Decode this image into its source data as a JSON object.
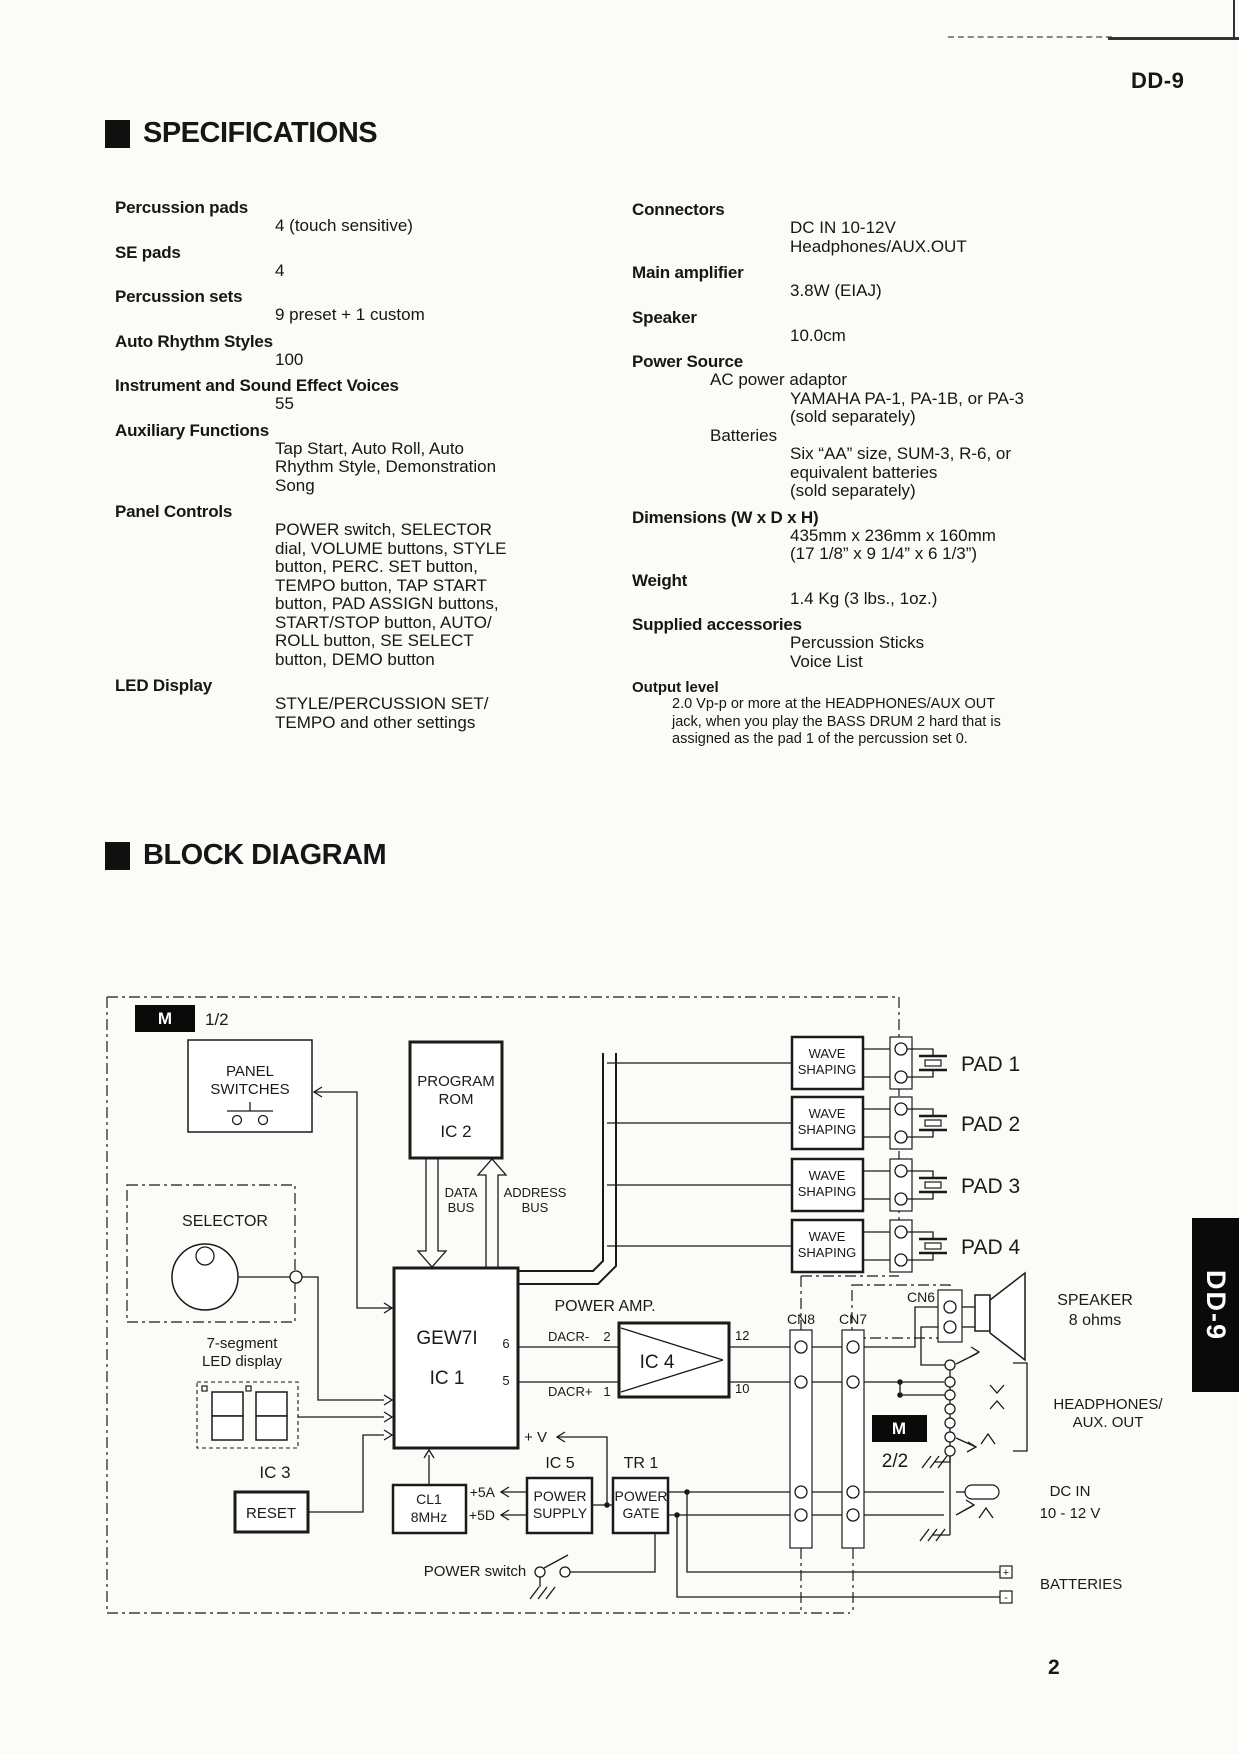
{
  "page": {
    "model": "DD-9",
    "number": "2",
    "side_tab": "DD-9"
  },
  "colors": {
    "ink": "#1a1a1a",
    "paper": "#fbfbf8"
  },
  "specifications": {
    "title": "SPECIFICATIONS",
    "left": [
      {
        "label": "Percussion pads",
        "value": "4 (touch sensitive)"
      },
      {
        "label": "SE pads",
        "value": "4"
      },
      {
        "label": "Percussion sets",
        "value": "9 preset + 1 custom"
      },
      {
        "label": "Auto Rhythm Styles",
        "value": "100"
      },
      {
        "label": "Instrument  and Sound Effect Voices",
        "value": "55"
      },
      {
        "label": "Auxiliary Functions",
        "value": "Tap Start, Auto Roll, Auto\nRhythm Style, Demonstration\nSong"
      },
      {
        "label": "Panel Controls",
        "value": "POWER switch, SELECTOR\ndial, VOLUME buttons, STYLE\nbutton, PERC. SET button,\nTEMPO button, TAP START\nbutton, PAD ASSIGN buttons,\nSTART/STOP button, AUTO/\nROLL button, SE SELECT\nbutton, DEMO button"
      },
      {
        "label": "LED Display",
        "value": "STYLE/PERCUSSION SET/\nTEMPO and other settings"
      }
    ],
    "right": [
      {
        "label": "Connectors",
        "value": "DC IN 10-12V\nHeadphones/AUX.OUT"
      },
      {
        "label": "Main amplifier",
        "value": "3.8W (EIAJ)"
      },
      {
        "label": "Speaker",
        "value": "10.0cm"
      },
      {
        "label": "Power Source",
        "sub1": "AC power adaptor",
        "sub1_value": "YAMAHA PA-1, PA-1B, or PA-3\n(sold separately)",
        "sub2": "Batteries",
        "sub2_value": "Six “AA” size, SUM-3, R-6, or\nequivalent batteries\n(sold separately)"
      },
      {
        "label": "Dimensions (W x D x H)",
        "value": "435mm x 236mm x 160mm\n(17 1/8” x 9 1/4” x 6 1/3”)"
      },
      {
        "label": "Weight",
        "value": "1.4 Kg (3 lbs., 1oz.)"
      },
      {
        "label": "Supplied accessories",
        "value": "Percussion Sticks\nVoice List"
      }
    ],
    "output_level": {
      "label": "Output level",
      "text": "2.0 Vp-p or more at the HEADPHONES/AUX OUT\njack, when you play the BASS DRUM 2 hard that is\nassigned as the pad 1 of the percussion set 0."
    }
  },
  "block_diagram": {
    "title": "BLOCK DIAGRAM",
    "marker_m": "M",
    "marker1_page": "1/2",
    "marker2_page": "2/2",
    "panel_switches_l1": "PANEL",
    "panel_switches_l2": "SWITCHES",
    "program_rom_l1": "PROGRAM",
    "program_rom_l2": "ROM",
    "ic2": "IC 2",
    "data_bus_l1": "DATA",
    "data_bus_l2": "BUS",
    "address_bus_l1": "ADDRESS",
    "address_bus_l2": "BUS",
    "selector": "SELECTOR",
    "seven_seg_l1": "7-segment",
    "seven_seg_l2": "LED display",
    "gew7i": "GEW7I",
    "ic1": "IC 1",
    "pin6": "6",
    "pin5": "5",
    "ic3": "IC 3",
    "reset": "RESET",
    "cl1_l1": "CL1",
    "cl1_l2": "8MHz",
    "power_amp": "POWER AMP.",
    "ic4": "IC 4",
    "dacr_minus": "DACR-",
    "dacr_minus_pin": "2",
    "dacr_plus": "DACR+",
    "dacr_plus_pin": "1",
    "out_pin_top": "12",
    "out_pin_bottom": "10",
    "wave_l1": "WAVE",
    "wave_l2": "SHAPING",
    "pads": [
      "PAD 1",
      "PAD 2",
      "PAD 3",
      "PAD 4"
    ],
    "cn8": "CN8",
    "cn7": "CN7",
    "cn6": "CN6",
    "speaker_l1": "SPEAKER",
    "speaker_l2": "8 ohms",
    "headphones_l1": "HEADPHONES/",
    "headphones_l2": "AUX. OUT",
    "plus_v": "+ V",
    "ic5": "IC 5",
    "power_supply_l1": "POWER",
    "power_supply_l2": "SUPPLY",
    "tr1": "TR 1",
    "power_gate_l1": "POWER",
    "power_gate_l2": "GATE",
    "plus_5a": "+5A",
    "plus_5d": "+5D",
    "power_switch": "POWER switch",
    "dc_in_l1": "DC IN",
    "dc_in_l2": "10 - 12 V",
    "batteries": "BATTERIES",
    "battery_plus": "+",
    "battery_minus": "-"
  }
}
